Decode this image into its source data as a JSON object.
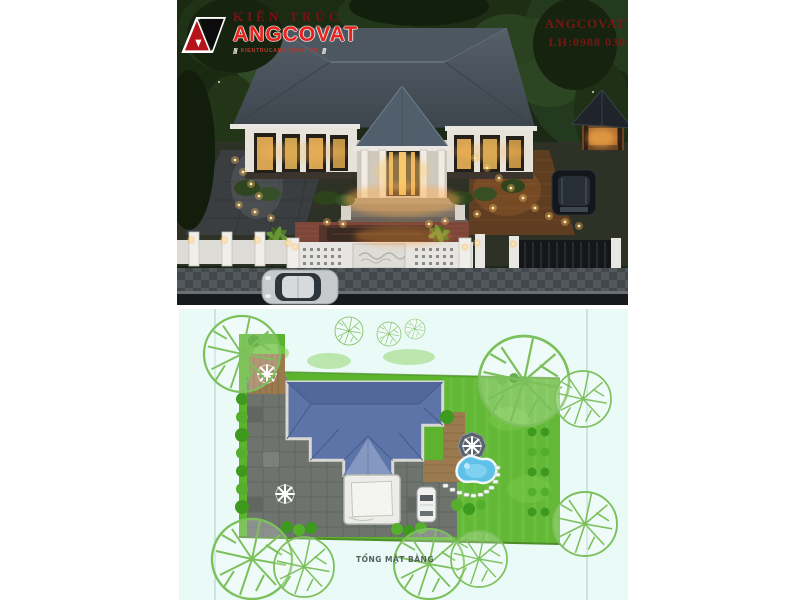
{
  "canvas": {
    "width": 800,
    "height": 600,
    "background": "#ffffff"
  },
  "watermark": {
    "brand_top": "KIẾN TRÚC",
    "brand_main": "ANGCOVAT",
    "slash_left": "///",
    "slash_right": "///",
    "brand_site": "KIENTRUCANGCOVAT.VN",
    "right_brand": "ANGCOVAT",
    "right_phone": "LH:0988 030",
    "brand_red": "#e8231d",
    "dark_red": "#801616"
  },
  "exterior_render": {
    "description": "Aerial dusk 3D render of a single-storey hip-roof villa with lit garden, central porch, brick courtyard, white fence, sidewalk, silver car and dark SUV, wooden gazebo at right",
    "palette": {
      "foliage": "#1c2916",
      "roof": "#4a5560",
      "walls": "#e7e3da",
      "warm_light": "#ffd98a",
      "brick_court": "#7c4638",
      "sidewalk": "#53585c",
      "road": "#17191c"
    }
  },
  "site_plan": {
    "label": "TỔNG MẶT BẰNG",
    "background": "#e9faf7",
    "palette": {
      "lawn": "#5cb32e",
      "roof": "#5c74a8",
      "paving": "#6e736d",
      "deck": "#9b7a50",
      "pool": "#5fc0e8",
      "tree_outline": "#7cc05c"
    },
    "features": [
      "house-roof",
      "front-courtyard",
      "parking-car",
      "wood-deck",
      "swimming-pool",
      "gazebo",
      "umbrella-seats",
      "lawn",
      "outline-trees",
      "stepping-stones"
    ]
  }
}
